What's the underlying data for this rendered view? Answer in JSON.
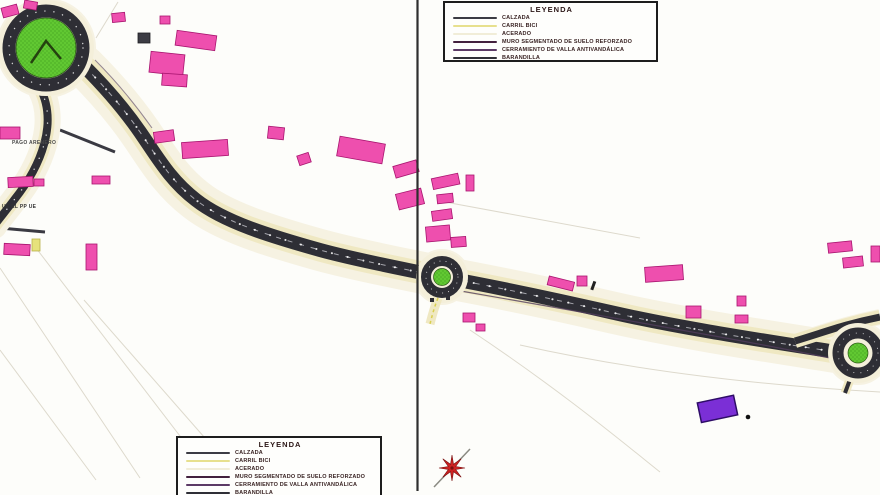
{
  "legend": {
    "title": "LEYENDA",
    "items": [
      {
        "label": "CALZADA",
        "color": "#3c3c44"
      },
      {
        "label": "CARRIL BICI",
        "color": "#e7e08e"
      },
      {
        "label": "ACERADO",
        "color": "#f1edd8"
      },
      {
        "label": "MURO SEGMENTADO DE SUELO REFORZADO",
        "color": "#43203d"
      },
      {
        "label": "CERRAMIENTO DE VALLA ANTIVANDÁLICA",
        "color": "#5c3a66"
      },
      {
        "label": "BARANDILLA",
        "color": "#2f2f36"
      }
    ]
  },
  "map_labels": {
    "pago": "PAGO ARENERO",
    "pp": "UE EL PP UE"
  },
  "colors": {
    "road_asphalt": "#2e2e35",
    "road_edge_cream": "#efe8c2",
    "corridor_halo": "#f6f2e2",
    "roundabout_green": "#61c832",
    "building_pink": "#ee4fae",
    "building_outline": "#a8156f",
    "building_purple": "#7b2fd6",
    "compass_red": "#cc2222",
    "divider": "#2e2e2e"
  },
  "icons": {
    "compass_rose_icon": "8-point red star with diagonal needle"
  }
}
